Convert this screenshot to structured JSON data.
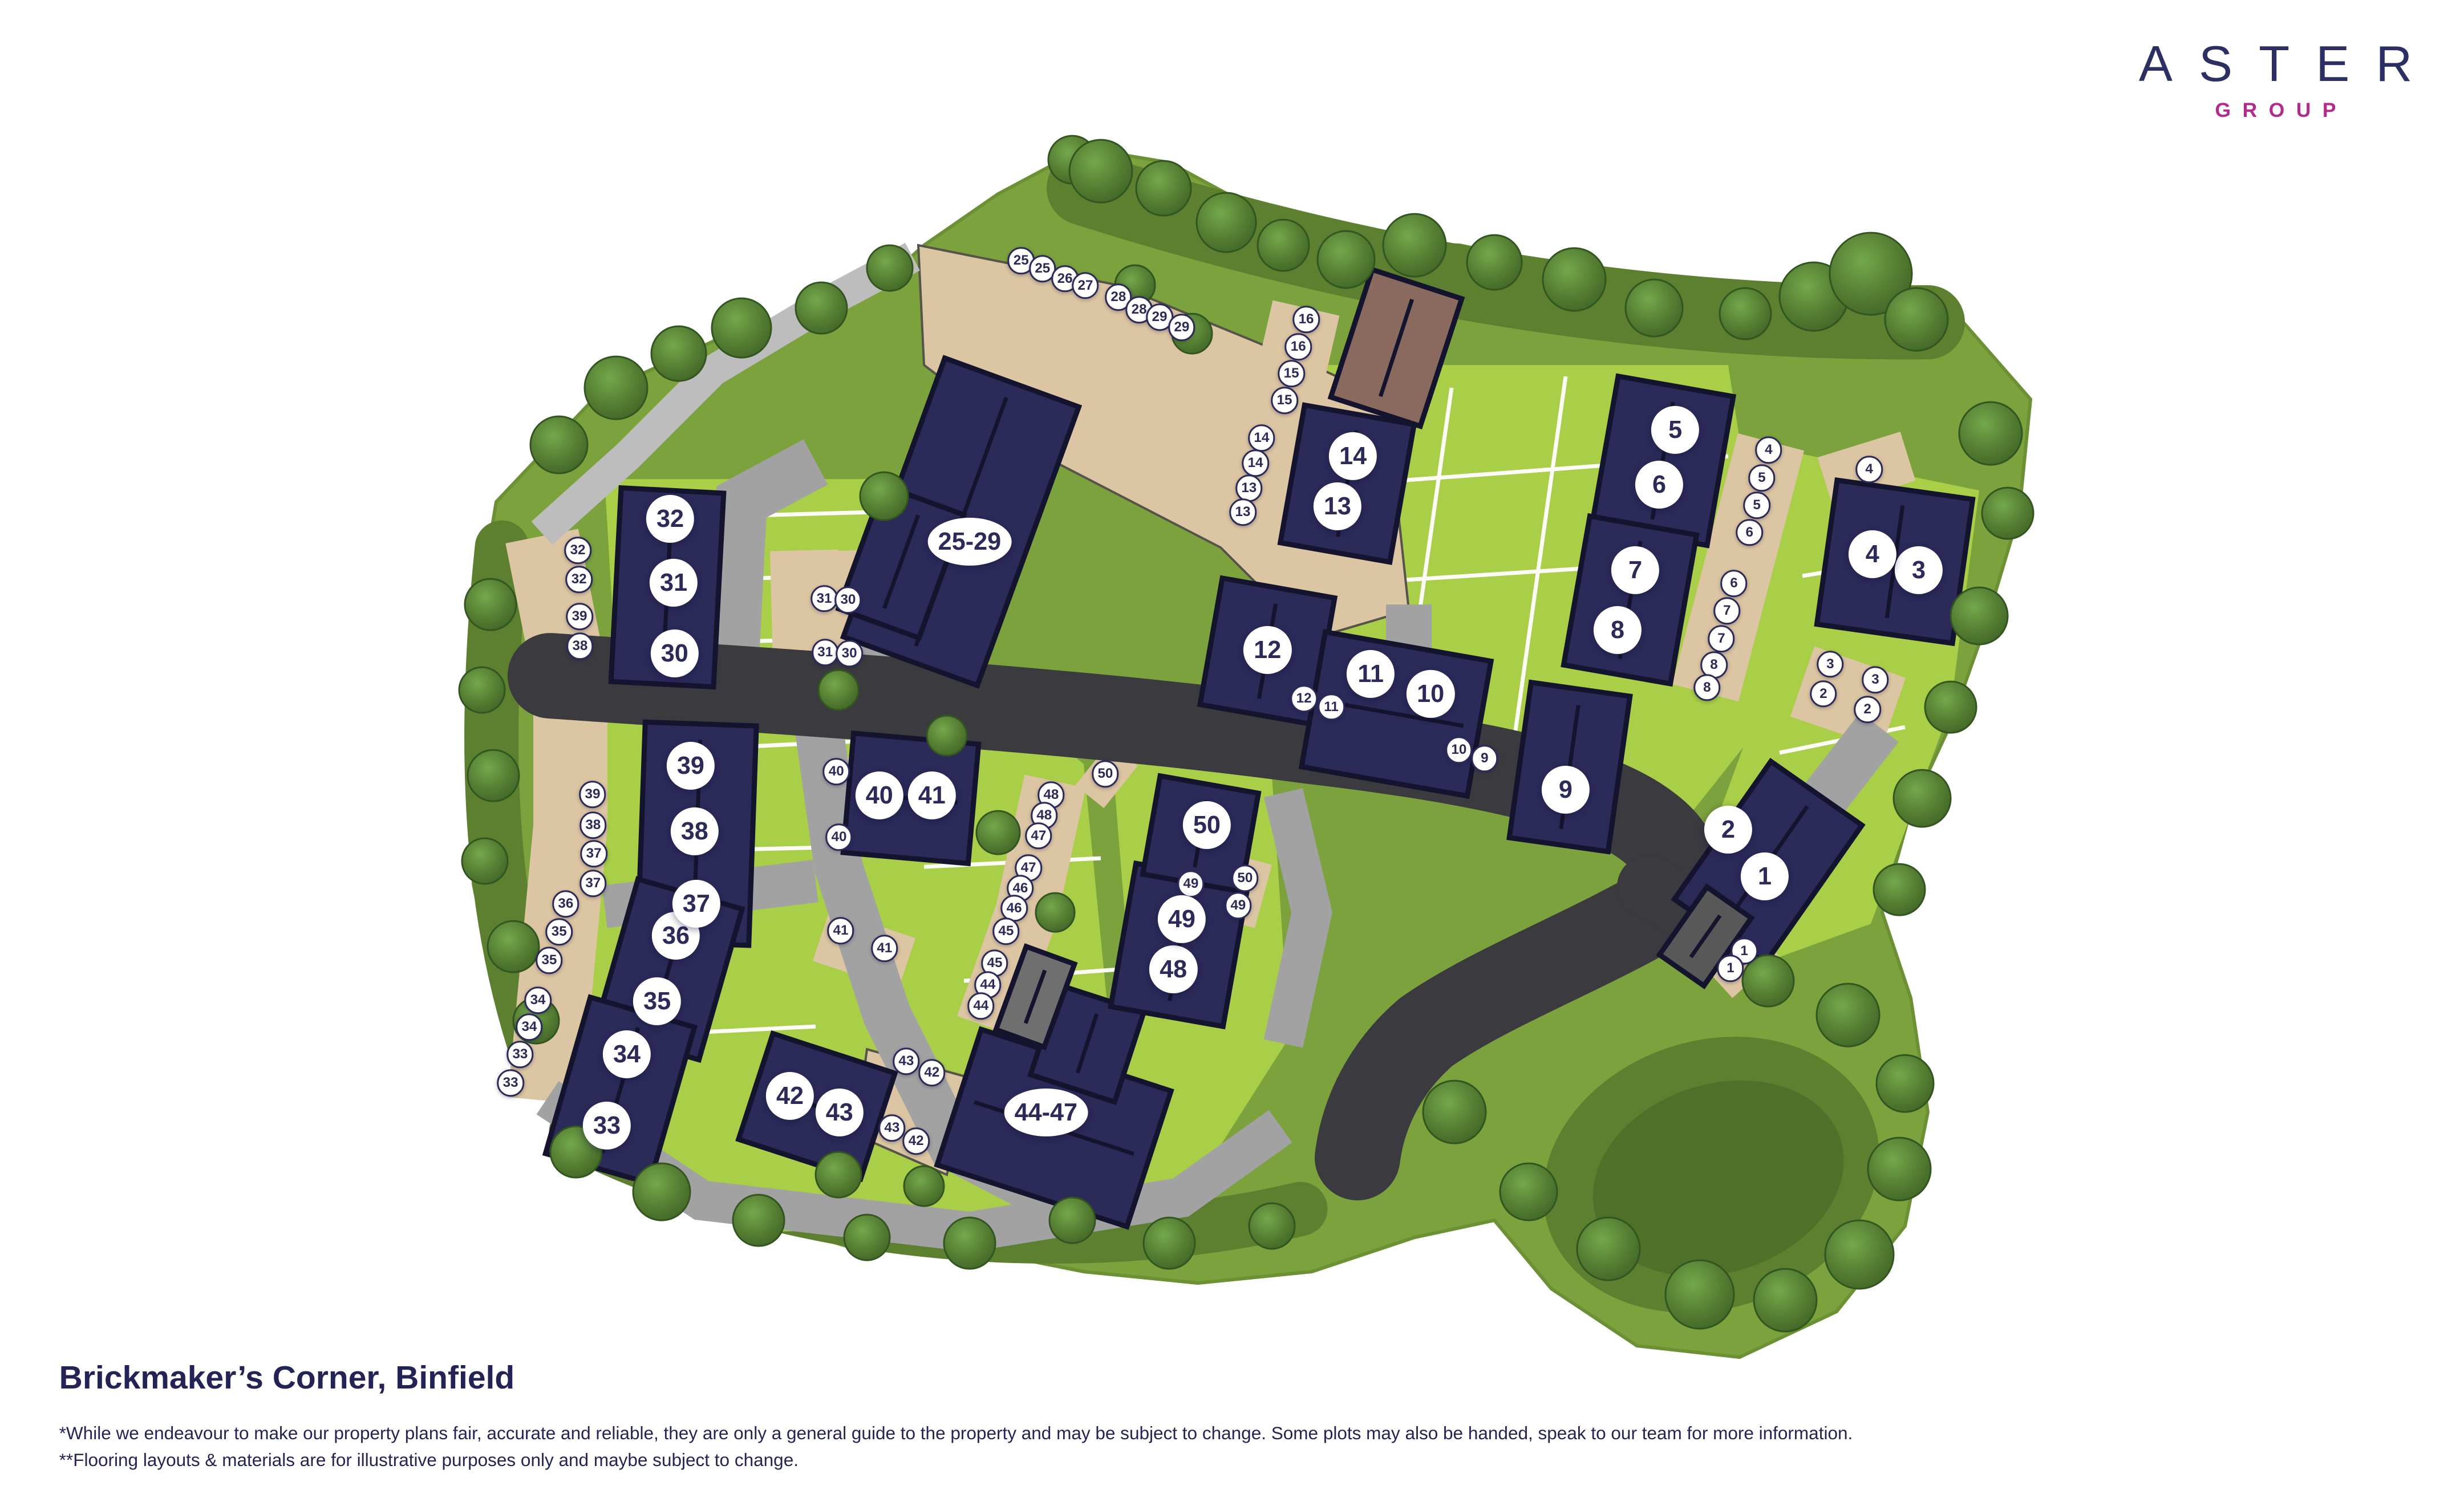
{
  "branding": {
    "logo_line1": "ASTER",
    "logo_line2": "GROUP"
  },
  "footer": {
    "title": "Brickmaker’s Corner, Binfield",
    "disclaimer_line1": "*While we endeavour to make our property plans fair, accurate and reliable, they are only a general guide to the property and may be subject to change. Some plots may also be handed, speak to our team for more information.",
    "disclaimer_line2": "**Flooring layouts & materials are for illustrative purposes only and maybe subject to change."
  },
  "map": {
    "site_name": "Brickmaker’s Corner, Binfield",
    "colors": {
      "building_navy": "#2b2a59",
      "building_brown": "#8a6a5e",
      "garage_grey": "#6f6f6f",
      "lawn_bright": "#a9ce47",
      "open_space_olive": "#7ba23c",
      "hedge_dark": "#5d8030",
      "street_beige": "#dcc5a2",
      "road_grey": "#a2a2a2",
      "road_asphalt": "#3b3b3f",
      "marker_text": "#2b2a59"
    },
    "plot_markers": [
      {
        "label": "1",
        "x": 71.62,
        "y": 58.82
      },
      {
        "label": "2",
        "x": 70.14,
        "y": 55.68
      },
      {
        "label": "3",
        "x": 77.87,
        "y": 38.27
      },
      {
        "label": "4",
        "x": 75.99,
        "y": 37.2
      },
      {
        "label": "5",
        "x": 67.99,
        "y": 28.86
      },
      {
        "label": "6",
        "x": 67.34,
        "y": 32.53
      },
      {
        "label": "7",
        "x": 66.37,
        "y": 38.27
      },
      {
        "label": "8",
        "x": 65.65,
        "y": 42.29
      },
      {
        "label": "9",
        "x": 63.54,
        "y": 53.0
      },
      {
        "label": "10",
        "x": 58.06,
        "y": 46.57
      },
      {
        "label": "11",
        "x": 55.63,
        "y": 45.24
      },
      {
        "label": "12",
        "x": 51.44,
        "y": 43.63
      },
      {
        "label": "13",
        "x": 54.28,
        "y": 33.98
      },
      {
        "label": "14",
        "x": 54.91,
        "y": 30.62
      },
      {
        "label": "25-29",
        "x": 39.35,
        "y": 36.36
      },
      {
        "label": "30",
        "x": 27.38,
        "y": 43.86
      },
      {
        "label": "31",
        "x": 27.34,
        "y": 39.11
      },
      {
        "label": "32",
        "x": 27.2,
        "y": 34.83
      },
      {
        "label": "33",
        "x": 24.63,
        "y": 75.55
      },
      {
        "label": "34",
        "x": 25.44,
        "y": 70.76
      },
      {
        "label": "35",
        "x": 26.67,
        "y": 67.2
      },
      {
        "label": "36",
        "x": 27.43,
        "y": 62.8
      },
      {
        "label": "37",
        "x": 28.26,
        "y": 60.66
      },
      {
        "label": "38",
        "x": 28.19,
        "y": 55.8
      },
      {
        "label": "39",
        "x": 28.03,
        "y": 51.4
      },
      {
        "label": "40",
        "x": 35.69,
        "y": 53.39
      },
      {
        "label": "41",
        "x": 37.82,
        "y": 53.39
      },
      {
        "label": "42",
        "x": 32.06,
        "y": 73.56
      },
      {
        "label": "43",
        "x": 34.07,
        "y": 74.67
      },
      {
        "label": "44-47",
        "x": 42.45,
        "y": 74.67
      },
      {
        "label": "48",
        "x": 47.62,
        "y": 65.06
      },
      {
        "label": "49",
        "x": 47.96,
        "y": 61.69
      },
      {
        "label": "50",
        "x": 48.98,
        "y": 55.38
      }
    ],
    "parking_markers": [
      {
        "label": "25",
        "x": 41.44,
        "y": 17.49
      },
      {
        "label": "25",
        "x": 42.31,
        "y": 18.03
      },
      {
        "label": "26",
        "x": 43.22,
        "y": 18.71
      },
      {
        "label": "27",
        "x": 44.05,
        "y": 19.17
      },
      {
        "label": "28",
        "x": 45.39,
        "y": 19.94
      },
      {
        "label": "28",
        "x": 46.23,
        "y": 20.78
      },
      {
        "label": "29",
        "x": 47.06,
        "y": 21.28
      },
      {
        "label": "29",
        "x": 47.96,
        "y": 21.97
      },
      {
        "label": "16",
        "x": 53.01,
        "y": 21.43
      },
      {
        "label": "16",
        "x": 52.69,
        "y": 23.27
      },
      {
        "label": "15",
        "x": 52.41,
        "y": 25.07
      },
      {
        "label": "15",
        "x": 52.13,
        "y": 26.87
      },
      {
        "label": "14",
        "x": 51.2,
        "y": 29.39
      },
      {
        "label": "14",
        "x": 50.95,
        "y": 31.08
      },
      {
        "label": "13",
        "x": 50.69,
        "y": 32.76
      },
      {
        "label": "13",
        "x": 50.44,
        "y": 34.37
      },
      {
        "label": "32",
        "x": 23.45,
        "y": 36.93
      },
      {
        "label": "32",
        "x": 23.5,
        "y": 38.88
      },
      {
        "label": "39",
        "x": 23.52,
        "y": 41.37
      },
      {
        "label": "38",
        "x": 23.54,
        "y": 43.36
      },
      {
        "label": "31",
        "x": 33.45,
        "y": 40.18
      },
      {
        "label": "30",
        "x": 34.42,
        "y": 40.26
      },
      {
        "label": "31",
        "x": 33.49,
        "y": 43.78
      },
      {
        "label": "30",
        "x": 34.47,
        "y": 43.86
      },
      {
        "label": "4",
        "x": 71.78,
        "y": 30.2
      },
      {
        "label": "5",
        "x": 71.5,
        "y": 32.07
      },
      {
        "label": "5",
        "x": 71.3,
        "y": 33.91
      },
      {
        "label": "6",
        "x": 71.0,
        "y": 35.74
      },
      {
        "label": "6",
        "x": 70.37,
        "y": 39.15
      },
      {
        "label": "7",
        "x": 70.09,
        "y": 40.99
      },
      {
        "label": "7",
        "x": 69.86,
        "y": 42.86
      },
      {
        "label": "8",
        "x": 69.56,
        "y": 44.62
      },
      {
        "label": "8",
        "x": 69.28,
        "y": 46.15
      },
      {
        "label": "4",
        "x": 75.86,
        "y": 31.5
      },
      {
        "label": "3",
        "x": 74.28,
        "y": 44.58
      },
      {
        "label": "3",
        "x": 76.11,
        "y": 45.62
      },
      {
        "label": "2",
        "x": 74.0,
        "y": 46.57
      },
      {
        "label": "2",
        "x": 75.79,
        "y": 47.61
      },
      {
        "label": "12",
        "x": 52.92,
        "y": 46.88
      },
      {
        "label": "11",
        "x": 54.03,
        "y": 47.45
      },
      {
        "label": "10",
        "x": 59.21,
        "y": 50.33
      },
      {
        "label": "9",
        "x": 60.25,
        "y": 50.9
      },
      {
        "label": "1",
        "x": 70.79,
        "y": 63.83
      },
      {
        "label": "1",
        "x": 70.23,
        "y": 64.98
      },
      {
        "label": "40",
        "x": 33.94,
        "y": 51.78
      },
      {
        "label": "40",
        "x": 34.05,
        "y": 56.18
      },
      {
        "label": "41",
        "x": 34.12,
        "y": 62.46
      },
      {
        "label": "41",
        "x": 35.9,
        "y": 63.64
      },
      {
        "label": "50",
        "x": 44.86,
        "y": 51.93
      },
      {
        "label": "49",
        "x": 48.33,
        "y": 59.32
      },
      {
        "label": "50",
        "x": 50.53,
        "y": 58.94
      },
      {
        "label": "49",
        "x": 50.25,
        "y": 60.77
      },
      {
        "label": "48",
        "x": 42.66,
        "y": 53.35
      },
      {
        "label": "48",
        "x": 42.38,
        "y": 54.73
      },
      {
        "label": "47",
        "x": 42.15,
        "y": 56.1
      },
      {
        "label": "47",
        "x": 41.74,
        "y": 58.25
      },
      {
        "label": "46",
        "x": 41.41,
        "y": 59.62
      },
      {
        "label": "46",
        "x": 41.16,
        "y": 60.96
      },
      {
        "label": "45",
        "x": 40.83,
        "y": 62.5
      },
      {
        "label": "45",
        "x": 40.37,
        "y": 64.64
      },
      {
        "label": "44",
        "x": 40.09,
        "y": 66.09
      },
      {
        "label": "44",
        "x": 39.81,
        "y": 67.51
      },
      {
        "label": "43",
        "x": 36.78,
        "y": 71.22
      },
      {
        "label": "42",
        "x": 37.82,
        "y": 71.99
      },
      {
        "label": "43",
        "x": 36.2,
        "y": 75.7
      },
      {
        "label": "42",
        "x": 37.18,
        "y": 76.58
      },
      {
        "label": "36",
        "x": 22.96,
        "y": 60.66
      },
      {
        "label": "35",
        "x": 22.69,
        "y": 62.53
      },
      {
        "label": "35",
        "x": 22.29,
        "y": 64.45
      },
      {
        "label": "34",
        "x": 21.83,
        "y": 67.13
      },
      {
        "label": "34",
        "x": 21.48,
        "y": 68.92
      },
      {
        "label": "33",
        "x": 21.11,
        "y": 70.76
      },
      {
        "label": "33",
        "x": 20.72,
        "y": 72.68
      },
      {
        "label": "39",
        "x": 24.05,
        "y": 53.31
      },
      {
        "label": "38",
        "x": 24.07,
        "y": 55.38
      },
      {
        "label": "37",
        "x": 24.1,
        "y": 57.29
      },
      {
        "label": "37",
        "x": 24.07,
        "y": 59.28
      }
    ]
  }
}
